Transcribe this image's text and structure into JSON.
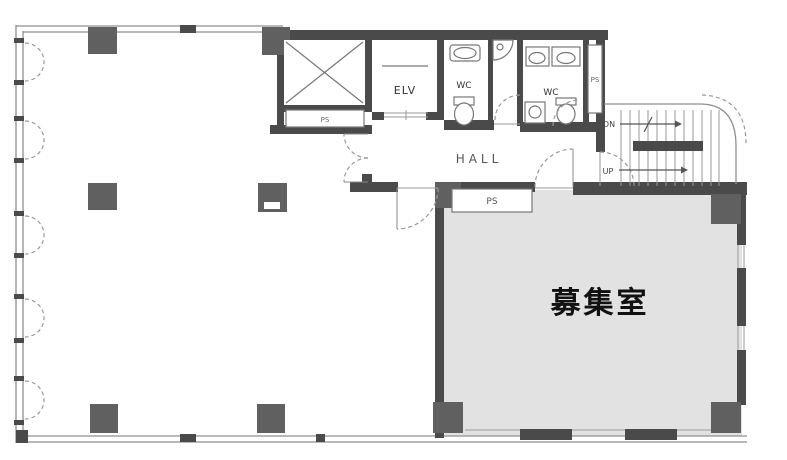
{
  "plan": {
    "kind": "building-floor-plan",
    "colors": {
      "wall": "#4a4a4a",
      "column": "#606060",
      "room_fill": "#e2e2e2",
      "thin_line": "#8f8f8f",
      "text": "#333333",
      "background": "#ffffff"
    },
    "labels": {
      "recruit_room": "募集室",
      "hall": "HALL",
      "elevator": "ELV",
      "wc_left": "WC",
      "wc_right": "WC",
      "ps_main": "PS",
      "ps_shaft": "PS",
      "ps_strip": "PS",
      "stairs_down": "DN",
      "stairs_up": "UP"
    }
  }
}
